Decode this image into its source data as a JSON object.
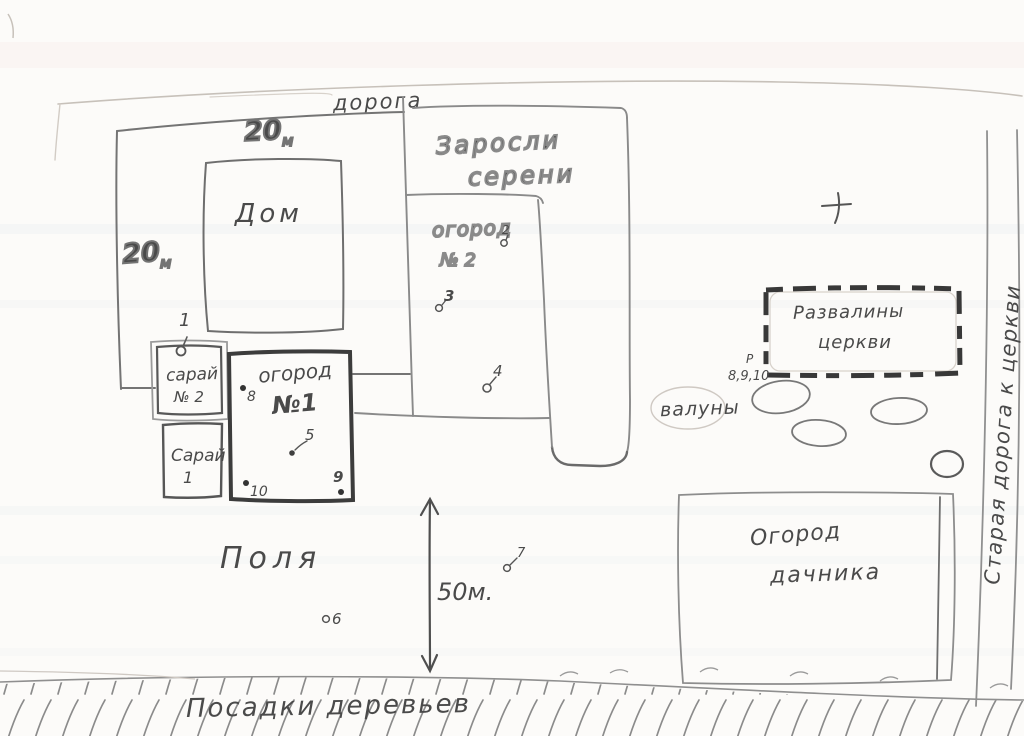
{
  "map": {
    "road_label": "дорога",
    "plot_width": {
      "value": "20",
      "unit": "м"
    },
    "plot_height": {
      "value": "20",
      "unit": "м"
    },
    "house_label": "Дом",
    "thicket": {
      "line1": "Заросли",
      "line2": "серени"
    },
    "garden2": {
      "line1": "огород",
      "line2": "№ 2"
    },
    "garden1": {
      "line1": "огород",
      "line2": "№1"
    },
    "shed2": {
      "line1": "сарай",
      "line2": "№ 2"
    },
    "shed1": {
      "line1": "Сарай",
      "line2": "1"
    },
    "fields_label": "Поля",
    "scale_label": "50м.",
    "boulders_label": "валуны",
    "ruins": {
      "line1": "Развалины",
      "line2": "церкви",
      "marker": "Р",
      "points_note": "8,9,10"
    },
    "dacha_garden": {
      "line1": "Огород",
      "line2": "дачника"
    },
    "old_road_label": "Старая дорога к церкви",
    "tree_plantings_label": "Посадки деревьев",
    "points": {
      "1": "1",
      "2": "2",
      "3": "3",
      "4": "4",
      "5": "5",
      "6": "6",
      "7": "7",
      "8": "8",
      "9": "9",
      "10": "10"
    },
    "colors": {
      "pencil": "#6e6e6e",
      "pencil_dark": "#3c3c3c",
      "pencil_faint": "#c7c1ba",
      "paper": "#fcfbf9"
    }
  }
}
